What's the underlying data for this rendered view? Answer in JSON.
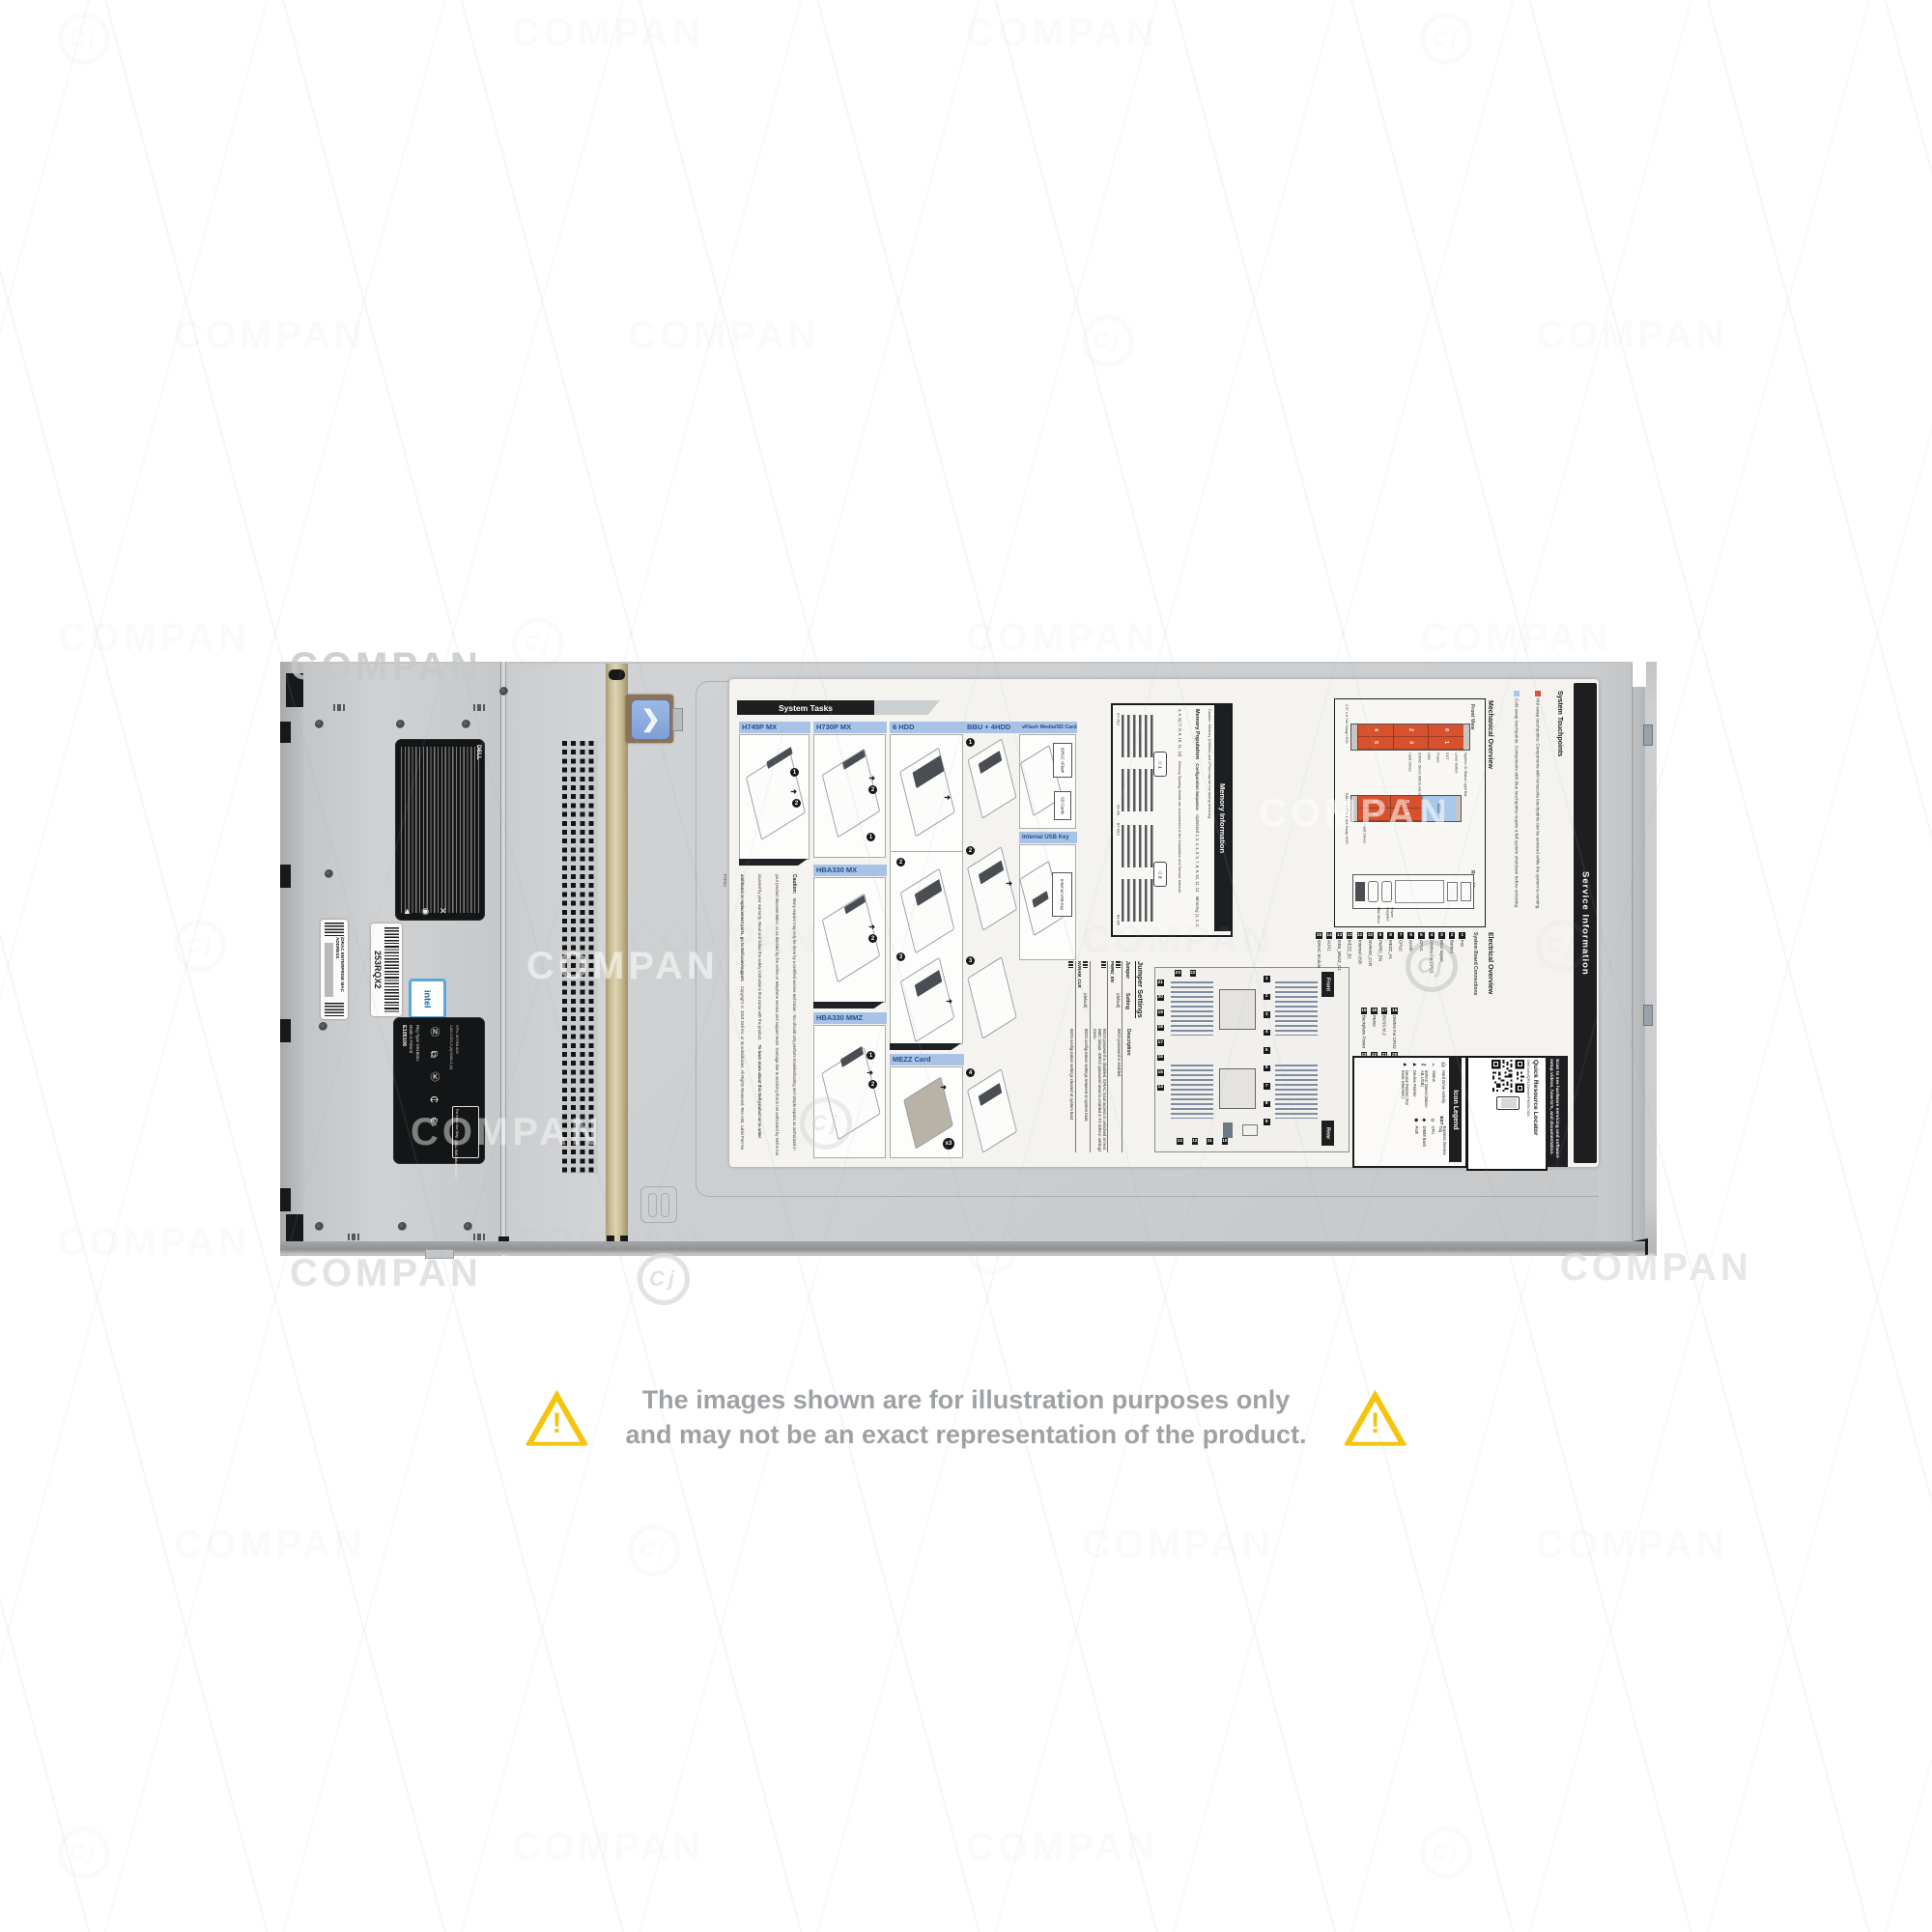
{
  "watermark": {
    "text": "COMPAN",
    "logo": "Cj"
  },
  "disclaimer": {
    "line1": "The images shown are for illustration purposes only",
    "line2": "and may not be an exact representation of the product."
  },
  "chassis": {
    "service_tag": "253RQX2",
    "mac_label": "iDRAC ENTERPRISE MAC ADDRESS",
    "brand": "DELL",
    "intel": "intel",
    "cert": {
      "ul": "E105106",
      "made": "Made in Poland",
      "model": "DELL EMC Model: E48S",
      "reg_type": "Reg Type: E04B001",
      "ices": "CAN ICES-3 (A)/NMB-3 (A)",
      "india": "For India Use Only",
      "dpn": "DPN: 807SM A00"
    }
  },
  "label": {
    "system_tasks": {
      "title": "System Tasks",
      "h745": "H745P MX",
      "h730": "H730P MX",
      "hdd6": "6 HDD",
      "hba_mx": "HBA330 MX",
      "hba_mmz": "HBA330 MMZ",
      "mezz": "MEZZ Card",
      "bbu4": "BBU + 4HDD",
      "vflash": "vFlash Media/SD Card",
      "usb_key": "Internal USB Key",
      "x3": "x3",
      "callouts": {
        "vflash": "iDRAC vFlash",
        "sd": "SD Cards",
        "usb": "Internal USB Key"
      },
      "steps": [
        "1",
        "2",
        "3",
        "4"
      ]
    },
    "caution": {
      "title": "Caution:",
      "body": "Many repairs may only be done by a certified service technician. You should only perform troubleshooting and simple repairs as authorized in your product documentation, or as directed by the online or telephone service and support team. Damage due to servicing that is not authorized by Dell is not covered by your warranty. Read and follow the safety instructions that came with the product.",
      "learn": "To learn more about this Dell product or to order additional or replacement parts, go to Dell.com/support.",
      "copyright": "Copyright © 2018 Dell Inc. or its subsidiaries. All Rights Reserved. Rev A00, Label Part No. F7FDJ"
    },
    "memory": {
      "title": "Memory Information",
      "caution": "Caution: Memory (DIMMs) and CPUs may be hot during servicing.",
      "population": "Memory Population",
      "config_header": "Configuration          Sequence",
      "rows": [
        {
          "line": "Optimized     1, 2, 3, 4, 5, 6, 7, 8, 9, 10, 11, 12"
        },
        {
          "line": "Mirroring      (1, 2, 3, 4, 5, 6) (7, 8, 9, 10, 11, 12)"
        }
      ],
      "note": "Memory Sparing details are documented in the Installation and Service Manual.",
      "groups": [
        {
          "top": "A7–A12",
          "bottom": "A1–A6",
          "cpu": "1"
        },
        {
          "top": "B7–B12",
          "bottom": "B1–B6",
          "cpu": "2"
        }
      ]
    },
    "service": {
      "title": "Service Information",
      "touchpoints": {
        "heading": "System Touchpoints",
        "hot": "Hot swap touchpoints: Components with terracotta touchpoints can be serviced while the system is running.",
        "cold": "Cold swap touchpoints: Components with blue touchpoints require a full system shutdown before servicing."
      },
      "mechanical": {
        "heading": "Mechanical Overview",
        "front_view": "Front View",
        "rear_view": "Rear View",
        "diag1_label": "2.5\" x 6 Hot Swap HDD",
        "diag2_label": "BBU + 2.5\" x 4 Hot Swap HDD",
        "drives1": [
          {
            "a": "4",
            "b": "5"
          },
          {
            "a": "2",
            "b": "3"
          },
          {
            "a": "0",
            "b": "1"
          }
        ],
        "drives2": [
          {
            "a": "2",
            "b": "3"
          },
          {
            "a": "0",
            "b": "1"
          }
        ],
        "bbu": "BBU",
        "callouts1": [
          "System ID Status Light Bar",
          "Lever Button",
          "EST",
          "Power",
          "USB",
          "iDRAC Direct (Micro-AB USB)",
          "Hard Drives"
        ],
        "callouts2": [
          "Hard Drives"
        ],
        "rear_callouts": [
          "Power Supplies",
          "Mini Mezz"
        ]
      },
      "electrical": {
        "heading": "Electrical Overview",
        "subheading": "System Board Connections",
        "front_tag": "Front",
        "rear_tag": "Rear",
        "items_row1": [
          {
            "n": "1",
            "t": "FIO"
          },
          {
            "n": "2",
            "t": "Battery"
          },
          {
            "n": "3",
            "t": "BBU Signal"
          },
          {
            "n": "4",
            "t": "DIMMs For CPU1"
          },
          {
            "n": "5",
            "t": "CPU1"
          },
          {
            "n": "6",
            "t": "AUX0"
          },
          {
            "n": "7",
            "t": "CPU2"
          },
          {
            "n": "8",
            "t": "MEZZ_A1"
          },
          {
            "n": "9",
            "t": "PWRD_EN"
          },
          {
            "n": "10",
            "t": "NVRAM_CLR"
          },
          {
            "n": "11",
            "t": "Internal USB"
          },
          {
            "n": "12",
            "t": "MEZZ_B1"
          },
          {
            "n": "13",
            "t": "MINI_MEZZ_C1"
          },
          {
            "n": "14",
            "t": "AUX1"
          },
          {
            "n": "15",
            "t": "iDRAC Module"
          }
        ],
        "items_row2": [
          {
            "n": "16",
            "t": "DIMMs For CPU2"
          },
          {
            "n": "17",
            "t": "BOSS M.2"
          },
          {
            "n": "18",
            "t": "PERC"
          },
          {
            "n": "19",
            "t": "Backplane Power"
          },
          {
            "n": "20",
            "t": "SATA"
          },
          {
            "n": "21",
            "t": "TPM"
          },
          {
            "n": "22",
            "t": "BBU Power"
          },
          {
            "n": "23",
            "t": "Backplane Signal"
          }
        ],
        "badges_left": [
          "21",
          "20",
          "19",
          "18",
          "17",
          "16",
          "15",
          "14"
        ],
        "badges_mid": [
          "1",
          "2",
          "3",
          "4",
          "5",
          "6",
          "7",
          "8",
          "9"
        ],
        "badges_bottom": [
          "13",
          "12",
          "11",
          "10"
        ],
        "badges_top": [
          "23",
          "22"
        ]
      },
      "jumpers": {
        "title": "Jumper Settings",
        "headers": [
          "Jumper",
          "Setting",
          "Description"
        ],
        "rows": [
          {
            "j": "PWRD_EN",
            "s": "(default)",
            "d": "BIOS password is enabled."
          },
          {
            "j": "",
            "s": "",
            "d": "BIOS password is disabled. iDRAC local access is unlocked at next BMC reboot. iDRAC password reset is enabled in F2 iDRAC settings menu."
          },
          {
            "j": "NVRAM_CLR",
            "s": "(default)",
            "d": "BIOS configuration settings retained at system boot."
          },
          {
            "j": "",
            "s": "",
            "d": "BIOS configuration settings cleared at system boot."
          }
        ]
      },
      "legend": {
        "title": "Icon Legend",
        "items_left": [
          {
            "i": "⛁",
            "t": "Hard Drive Activity"
          },
          {
            "i": "⌁",
            "t": "Status"
          },
          {
            "i": "⚷",
            "t": "iDRAC Direct (Micro-AB USB)"
          },
          {
            "i": "▲",
            "t": "Device Pointer"
          },
          {
            "i": "▲",
            "t": "Device Pointer (For more Direction)"
          }
        ],
        "items_right": [
          {
            "i": "EST",
            "t": "Express Service Tag"
          },
          {
            "i": "◇",
            "t": "CPU"
          },
          {
            "i": "◆",
            "t": "DIMM Bank"
          },
          {
            "i": "◉",
            "t": "Path"
          }
        ]
      },
      "qrl": {
        "title": "Quick Resource Locator",
        "url": "Dell.com/QRL/Server/PEMX740c"
      },
      "scan": "Scan to see hardware servicing and software setup videos, how-to's, and documentation."
    }
  }
}
